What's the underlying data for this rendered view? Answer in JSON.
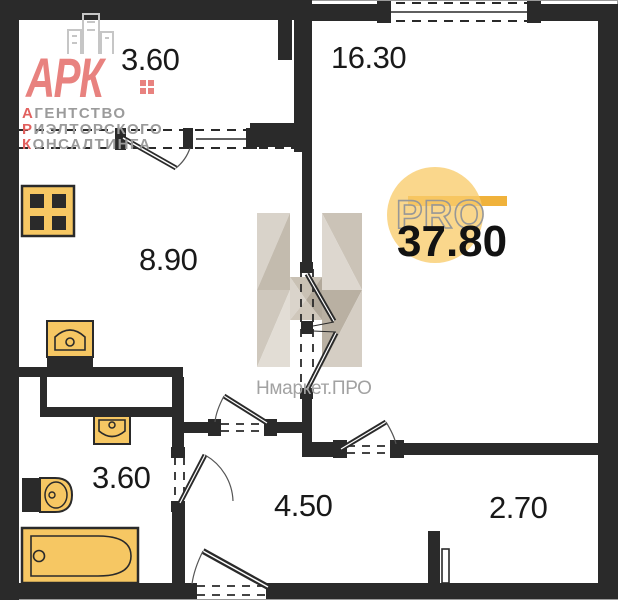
{
  "branding": {
    "agency": {
      "name": "АРК",
      "slogan": [
        {
          "accent": "А",
          "rest": "ГЕНТСТВО"
        },
        {
          "accent": "Р",
          "rest": "ИЭЛТОРСКОГО"
        },
        {
          "accent": "К",
          "rest": "ОНСАЛТИНГА"
        }
      ]
    },
    "watermark": {
      "text": "Нмаркет.ПРО"
    },
    "pro_badge": {
      "label": "PRO",
      "total_area": "37.80"
    }
  },
  "rooms": [
    {
      "name": "balcony",
      "area": "3.60"
    },
    {
      "name": "living-room",
      "area": "16.30"
    },
    {
      "name": "kitchen",
      "area": "8.90"
    },
    {
      "name": "bathroom",
      "area": "3.60"
    },
    {
      "name": "hallway",
      "area": "4.50"
    },
    {
      "name": "storage",
      "area": "2.70"
    }
  ],
  "colors": {
    "wall": "#2a2a2a",
    "fixture_fill": "#f6c763",
    "brand_red": "#e2605e",
    "brand_gray": "#9b9b9b",
    "pro_circle": "#f8cc6b",
    "pro_bar": "#f0b23b",
    "watermark_gray": "#a2a2a2"
  }
}
